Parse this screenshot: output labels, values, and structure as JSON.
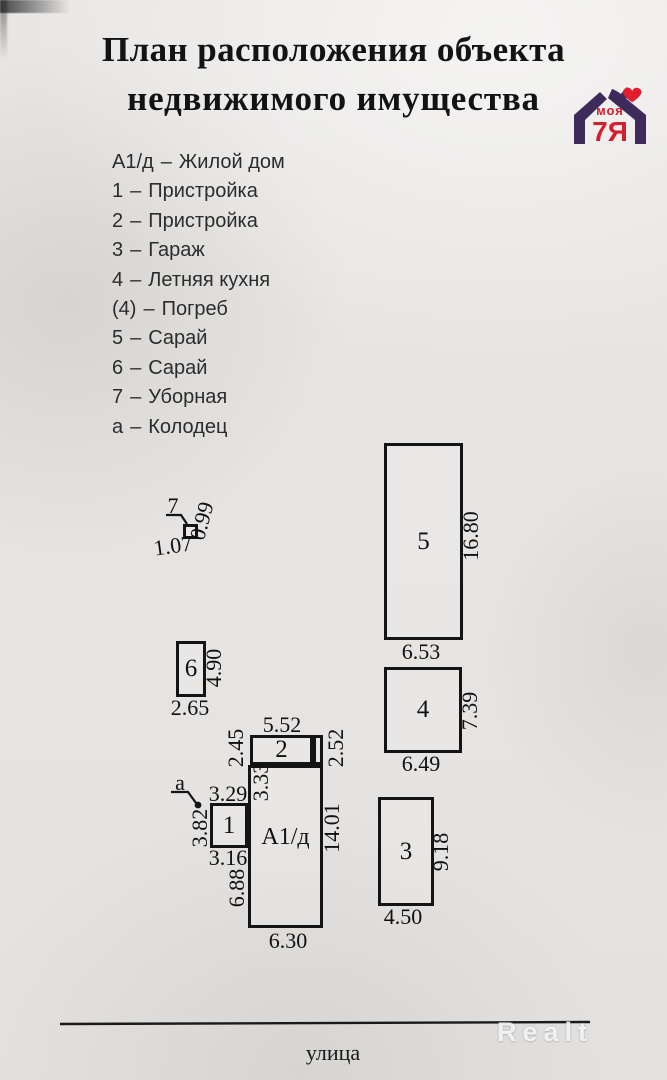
{
  "title": {
    "line1": "План расположения объекта",
    "line2": "недвижимого имущества"
  },
  "logo": {
    "brand_top": "моя",
    "brand_main": "7Я"
  },
  "legend": {
    "separator": "–",
    "items": [
      {
        "key": "А1/д",
        "label": "Жилой дом"
      },
      {
        "key": "1",
        "label": "Пристройка"
      },
      {
        "key": "2",
        "label": "Пристройка"
      },
      {
        "key": "3",
        "label": "Гараж"
      },
      {
        "key": "4",
        "label": "Летняя кухня"
      },
      {
        "key": "(4)",
        "label": "Погреб"
      },
      {
        "key": "5",
        "label": "Сарай"
      },
      {
        "key": "6",
        "label": "Сарай"
      },
      {
        "key": "7",
        "label": "Уборная"
      },
      {
        "key": "а",
        "label": "Колодец"
      }
    ]
  },
  "plan": {
    "b5": {
      "num": "5",
      "w": "6.53",
      "h": "16.80"
    },
    "b4": {
      "num": "4",
      "w": "6.49",
      "h": "7.39"
    },
    "b3": {
      "num": "3",
      "w": "4.50",
      "h": "9.18"
    },
    "b6": {
      "num": "6",
      "w": "2.65",
      "h": "4.90"
    },
    "b7": {
      "num": "7",
      "w": "1.07",
      "h": "0.99"
    },
    "b2": {
      "num": "2",
      "w": "5.52",
      "h_left": "2.45",
      "h_right": "2.52"
    },
    "b1": {
      "num": "1",
      "w_top": "3.29",
      "w_bottom": "3.16",
      "h_left": "3.82"
    },
    "a1d": {
      "num": "А1/д",
      "seg_left_top": "3.33",
      "seg_left_bottom": "6.88",
      "h_right": "14.01",
      "w_bottom": "6.30"
    },
    "well": {
      "key": "а"
    },
    "street_label": "улица"
  },
  "watermark": "Realt",
  "colors": {
    "logo_purple": "#3e2a5b",
    "logo_red": "#d41f2f",
    "ink": "#141414",
    "paper": "#e6e4e2"
  }
}
